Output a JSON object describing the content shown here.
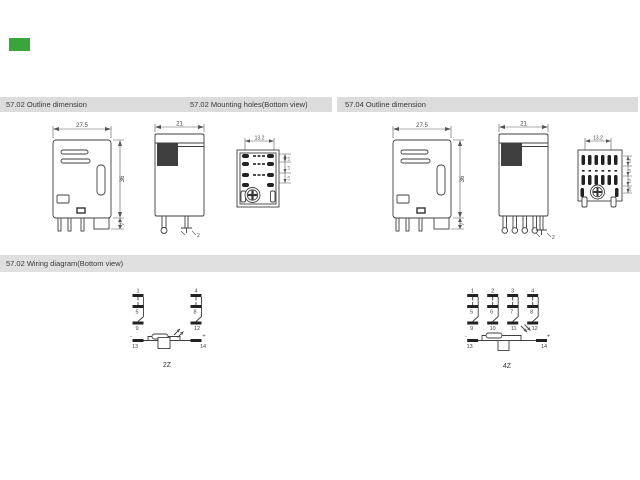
{
  "colors": {
    "accent_green": "#3aa53a",
    "header_bg": "#dcdcdc",
    "line": "#3f3f3f"
  },
  "sections": {
    "outline_5702_title": "57.02 Outline  dimension",
    "mounting_5702_title": "57.02 Mounting holes(Bottom view)",
    "outline_5704_title": "57.04  Outline  dimension",
    "wiring_title": "57.02 Wiring diagram(Bottom view)"
  },
  "dim_5702": {
    "front_width": "27.5",
    "front_height": "36",
    "pin_len": "7",
    "side_width": "21",
    "pin_thickness": "2",
    "hole_pitch": "13.2",
    "hole_side_dims": [
      "4.8",
      "4.8",
      "4.8"
    ]
  },
  "dim_5704": {
    "front_width": "27.5",
    "front_height": "36",
    "pin_len": "7",
    "side_width": "21",
    "pin_thickness": "2",
    "hole_pitch": "13.2",
    "hole_side_dims": [
      "4.8",
      "4.8",
      "4.8",
      "4.8"
    ]
  },
  "wiring_2z": {
    "label": "2Z",
    "pins_top": [
      "1",
      "4"
    ],
    "pins_mid": [
      "5",
      "8"
    ],
    "pins_bottom": [
      "9",
      "12"
    ],
    "pin_coil_left": "13",
    "pin_coil_right": "14",
    "polarity_left": "-",
    "polarity_right": "+"
  },
  "wiring_4z": {
    "label": "4Z",
    "pins_top": [
      "1",
      "2",
      "3",
      "4"
    ],
    "pins_mid": [
      "5",
      "6",
      "7",
      "8"
    ],
    "pins_bottom": [
      "9",
      "10",
      "11",
      "12"
    ],
    "pin_coil_left": "13",
    "pin_coil_right": "14",
    "polarity_left": "-",
    "polarity_right": "+"
  }
}
